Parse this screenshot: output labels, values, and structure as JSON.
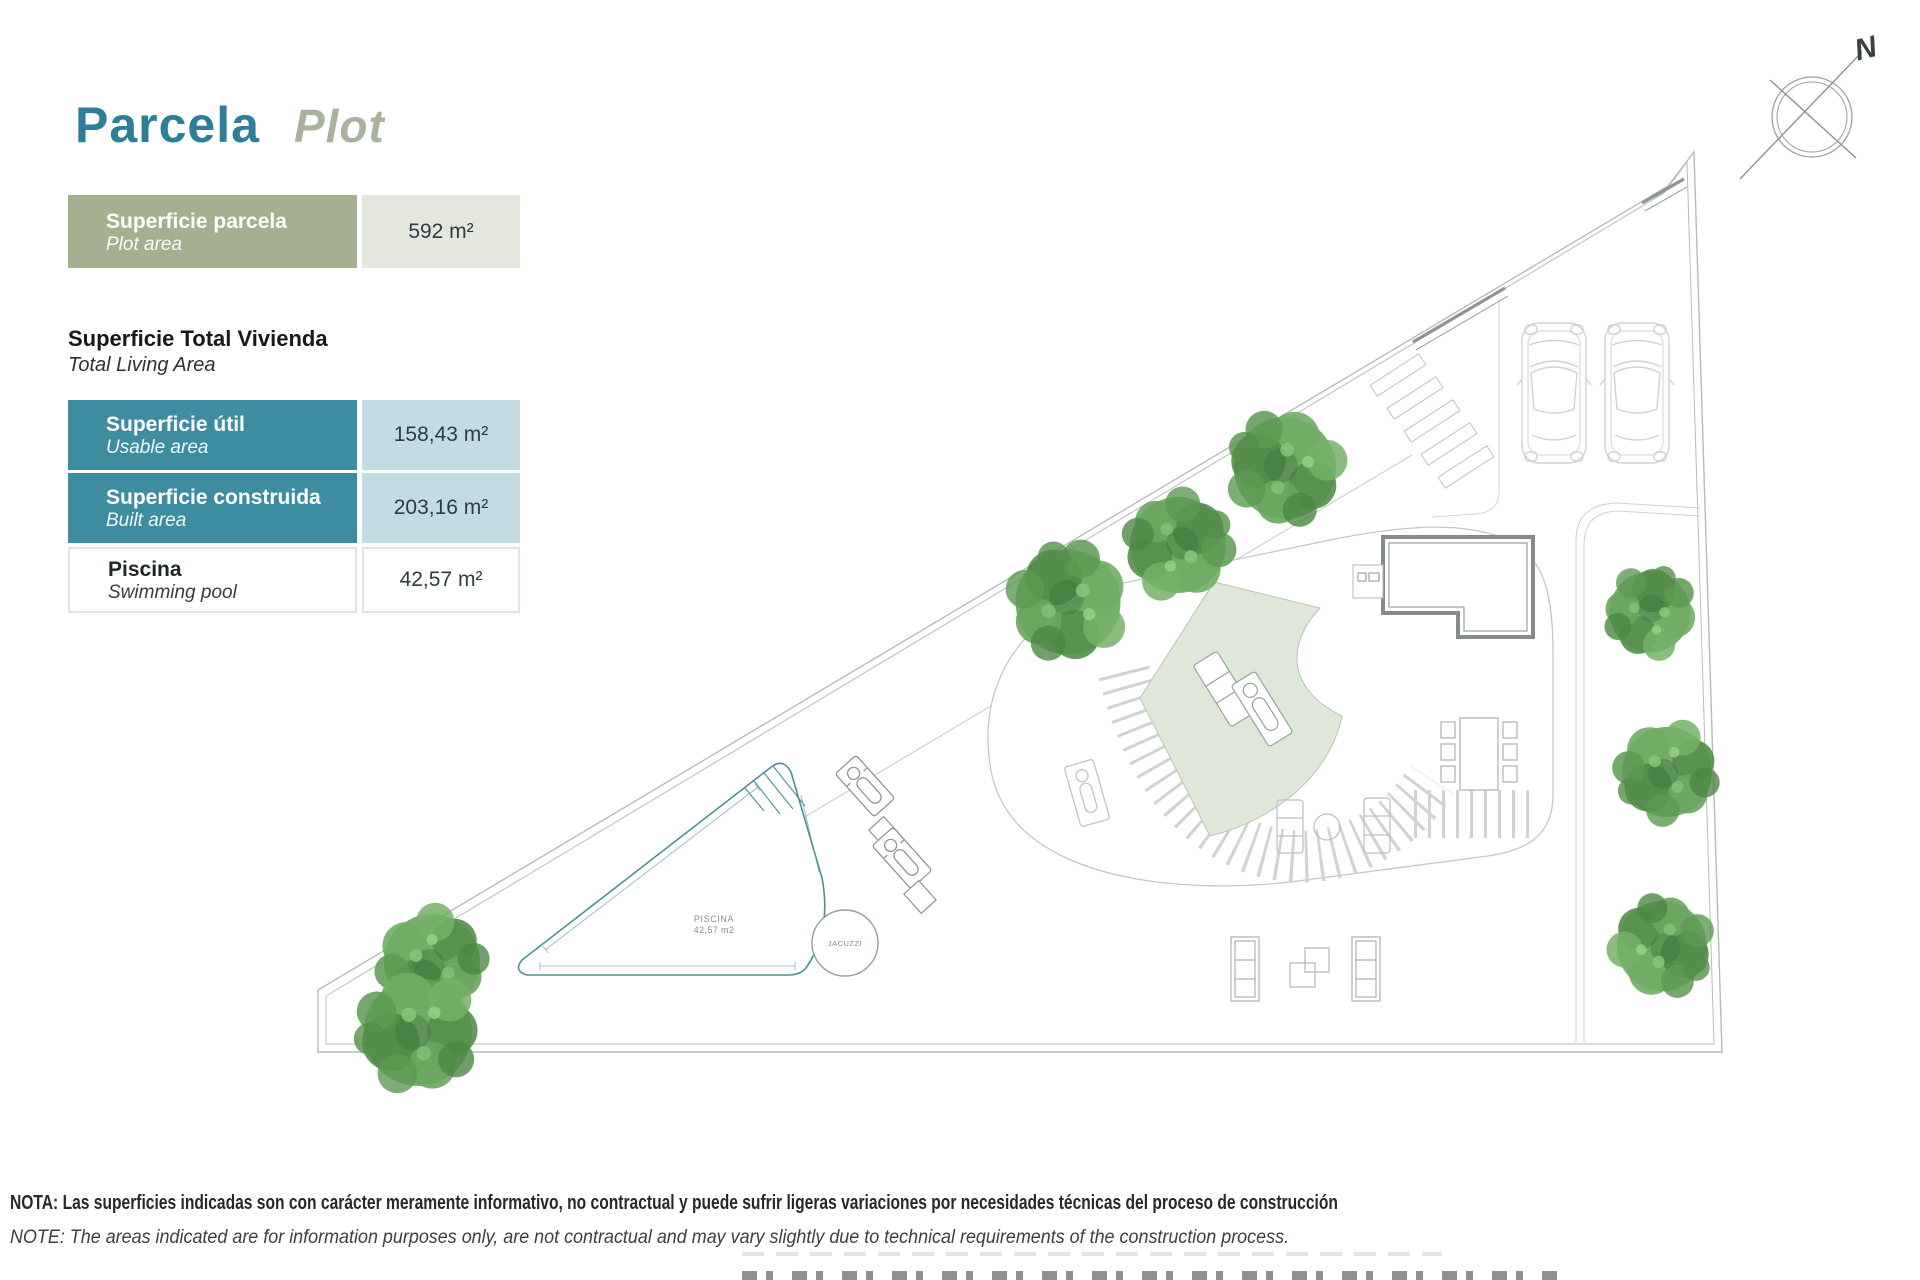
{
  "page": {
    "title_es": "Parcela",
    "title_en": "Plot",
    "compass_label": "N"
  },
  "table": {
    "row_parcela": {
      "label_es": "Superficie parcela",
      "label_en": "Plot area",
      "value": "592 m²"
    },
    "heading_es": "Superficie Total Vivienda",
    "heading_en": "Total Living Area",
    "rows": [
      {
        "label_es": "Superficie útil",
        "label_en": "Usable area",
        "value": "158,43 m²"
      },
      {
        "label_es": "Superficie construida",
        "label_en": "Built area",
        "value": "203,16 m²"
      },
      {
        "label_es": "Piscina",
        "label_en": "Swimming pool",
        "value": "42,57 m²"
      }
    ]
  },
  "plan": {
    "pool_label": "PISCINA",
    "pool_area": "42,57 m2",
    "jacuzzi_label": "JACUZZI"
  },
  "notes": {
    "es": "NOTA: Las superficies indicadas son con carácter meramente informativo, no contractual y puede sufrir ligeras variaciones por necesidades técnicas del proceso de construcción",
    "en": "NOTE: The areas indicated are for information purposes only, are not contractual and may vary slightly due to technical requirements of the construction process."
  },
  "colors": {
    "title_teal": "#2e7e99",
    "title_sage": "#a9b29c",
    "row_green": "#a4b091",
    "row_green_value_bg": "#e4e7de",
    "row_teal": "#3e8ca0",
    "row_teal_value_bg": "#c3dce2",
    "pool_line": "#4d8f96",
    "lawn": "#dfe8d8",
    "tree_green": "#5d9a55"
  }
}
